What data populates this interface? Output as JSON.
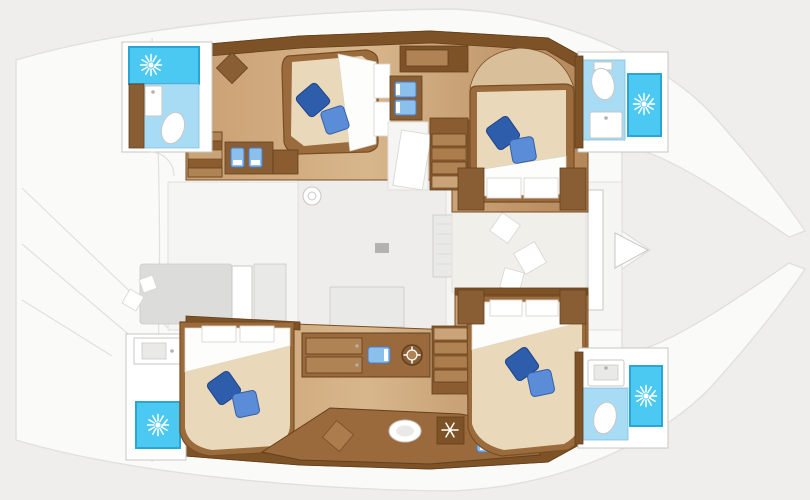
{
  "title": "Catamaran yacht interior layout - top-view floor plan with 4 cabins and 4 bathrooms",
  "orientation": {
    "bow": "right",
    "stern": "left",
    "port_hull": "top",
    "starboard_hull": "bottom"
  },
  "colors": {
    "background": "#efeeec",
    "deck": "#fafaf9",
    "deck_line": "#e1e0de",
    "salon_floor": "#f5f5f3",
    "pale_area": "#eeedeb",
    "lounge_pad": "#f1efe9",
    "wall": "#7e5227",
    "wall_line": "#63401d",
    "wood_line": "#7a4e22",
    "wood_dark": "#8a5c30",
    "wood": "#ab7c4c",
    "wood_light": "#c9a478",
    "floor_light": "#d8b68c",
    "floor_mid": "#b4875a",
    "counter": "#9a6a3d",
    "drawer": "#b08354",
    "cabinet": "#8a5e35",
    "bed_frame": "#9a6b3c",
    "mattress": "#ead8ba",
    "mattress_shadow": "#d9c09a",
    "sheet": "#fdfdfb",
    "sheet_line": "#ddd6c6",
    "panel_line": "#d9d8d5",
    "pillow_dark": "#2e5dab",
    "pillow_dark_line": "#1d4488",
    "pillow_light": "#5b8cd8",
    "pillow_light_line": "#3560a8",
    "shower": "#4cc9f2",
    "shower_border": "#2aa6d4",
    "bath_floor": "#a8dcf4",
    "bath_line": "#7fc0e0",
    "sink_blue": "#8cc0ec",
    "sink_blue_line": "#4a7fd0",
    "fixture": "#ffffff",
    "fixture_line": "#c8c7c5",
    "gray_sofa": "#dcdcdb",
    "gray_light": "#e9e9e7",
    "gray_line": "#cbcac8",
    "icon": "#ffffff",
    "metal": "#b3b2b0"
  },
  "icons": {
    "shower": "cyan-square-with-white-sunburst",
    "toilet": "white-oval-bowl",
    "washbasin": "white-rectangle-with-faucet-dot",
    "twin_vanity_sinks": "blue-rectangles-pair",
    "galley_sink": "blue-rounded-rectangle",
    "galley_round_basin": "white-oval-in-counter",
    "cooktop_dial": "dark-ring-with-white-ticks",
    "freezer": "dark-square-with-white-snowflake",
    "bed_pillows": "two-rotated-blue-squares",
    "deck_hatch": "small-gray-circle",
    "bow_pointer": "white-right-arrow-triangle"
  },
  "rooms": [
    {
      "id": "port-aft-cabin",
      "name": "Port aft cabin",
      "features": [
        "double-berth",
        "two-blue-pillows",
        "headboard-panels",
        "wardrobe-door",
        "vanity-with-two-seats",
        "steps"
      ]
    },
    {
      "id": "port-aft-bathroom",
      "name": "Port aft bathroom",
      "features": [
        "shower-stall",
        "toilet",
        "washbasin",
        "cabinet"
      ]
    },
    {
      "id": "port-forward-cabin",
      "name": "Port forward cabin",
      "features": [
        "double-berth",
        "two-blue-pillows",
        "foot-panels",
        "wardrobes"
      ]
    },
    {
      "id": "port-forward-bathroom",
      "name": "Port forward bathroom",
      "features": [
        "shower-stall",
        "toilet",
        "washbasin"
      ]
    },
    {
      "id": "port-companionway",
      "name": "Port companionway",
      "features": [
        "stairs",
        "twin-blue-sinks-vanity",
        "door"
      ]
    },
    {
      "id": "salon",
      "name": "Salon on bridge deck",
      "features": [
        "sofa",
        "table",
        "gray-lounge",
        "sideboard",
        "deck-hatch"
      ]
    },
    {
      "id": "forward-lounge",
      "name": "Forward lounge pad",
      "features": [
        "sun-pad",
        "scatter-pillows",
        "bow-pointer"
      ]
    },
    {
      "id": "starboard-aft-cabin",
      "name": "Starboard aft cabin",
      "features": [
        "double-berth",
        "two-blue-pillows",
        "headboard-panels"
      ]
    },
    {
      "id": "starboard-aft-washroom",
      "name": "Starboard aft washroom",
      "features": [
        "shower-stall",
        "washbasin"
      ]
    },
    {
      "id": "galley",
      "name": "Galley in starboard hull",
      "features": [
        "blue-sink",
        "cooktop-dial",
        "drawer-stack",
        "round-basin",
        "freezer-snowflake",
        "blue-stool",
        "stairs"
      ]
    },
    {
      "id": "starboard-forward-cabin",
      "name": "Starboard forward cabin",
      "features": [
        "double-berth",
        "two-blue-pillows",
        "headboard-panels",
        "wardrobes"
      ]
    },
    {
      "id": "starboard-forward-bathroom",
      "name": "Starboard forward bathroom",
      "features": [
        "shower-stall",
        "toilet",
        "washbasin"
      ]
    }
  ],
  "inventory": {
    "cabins_with_double_berth": 4,
    "shower_stalls": 4,
    "toilets": 3,
    "washbasins": 8,
    "companionway_stairs": 3,
    "blue_pillows_per_bed": 2
  }
}
